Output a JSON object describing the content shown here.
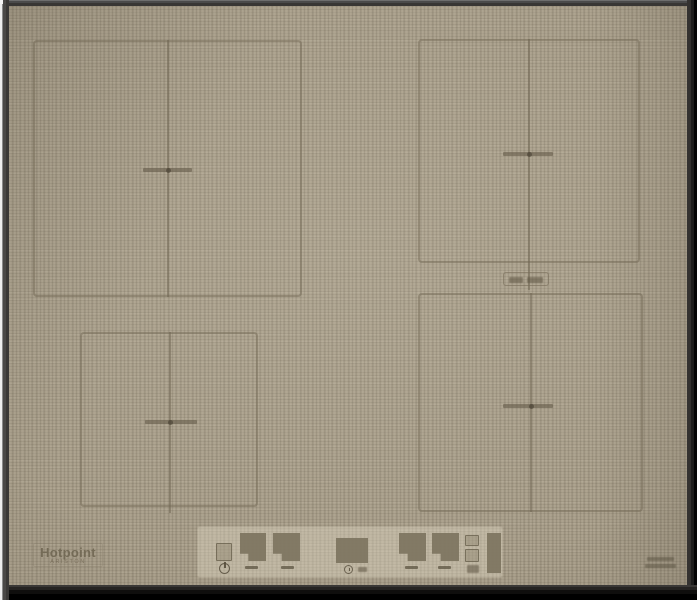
{
  "device": {
    "description": "Hotpoint induction hob with beige linen-textured glass, four flexi cooking zones and bottom touch-control strip"
  },
  "brand": {
    "name": "Hotpoint",
    "subname": "ARISTON"
  },
  "colors": {
    "surface": "#a89e8a",
    "engraved_line": "#766c58",
    "panel_strip": "#d7cfb9",
    "display_window": "#7d745f",
    "bezel_dark": "#141414",
    "bezel_light": "#eeeeee"
  },
  "zones": {
    "count": 4,
    "items": [
      {
        "id": "top-left"
      },
      {
        "id": "top-right"
      },
      {
        "id": "bottom-left"
      },
      {
        "id": "bottom-right"
      }
    ]
  },
  "panel": {
    "icons": {
      "power": "power-standby-symbol",
      "timer": "clock-symbol",
      "watt": "wattage-mark"
    },
    "keys": [
      "power-key",
      "zone-display-front-left",
      "zone-display-back-left",
      "timer-display",
      "zone-display-back-right",
      "zone-display-front-right",
      "option-key-upper",
      "option-key-lower",
      "side-indicator-bar"
    ]
  }
}
